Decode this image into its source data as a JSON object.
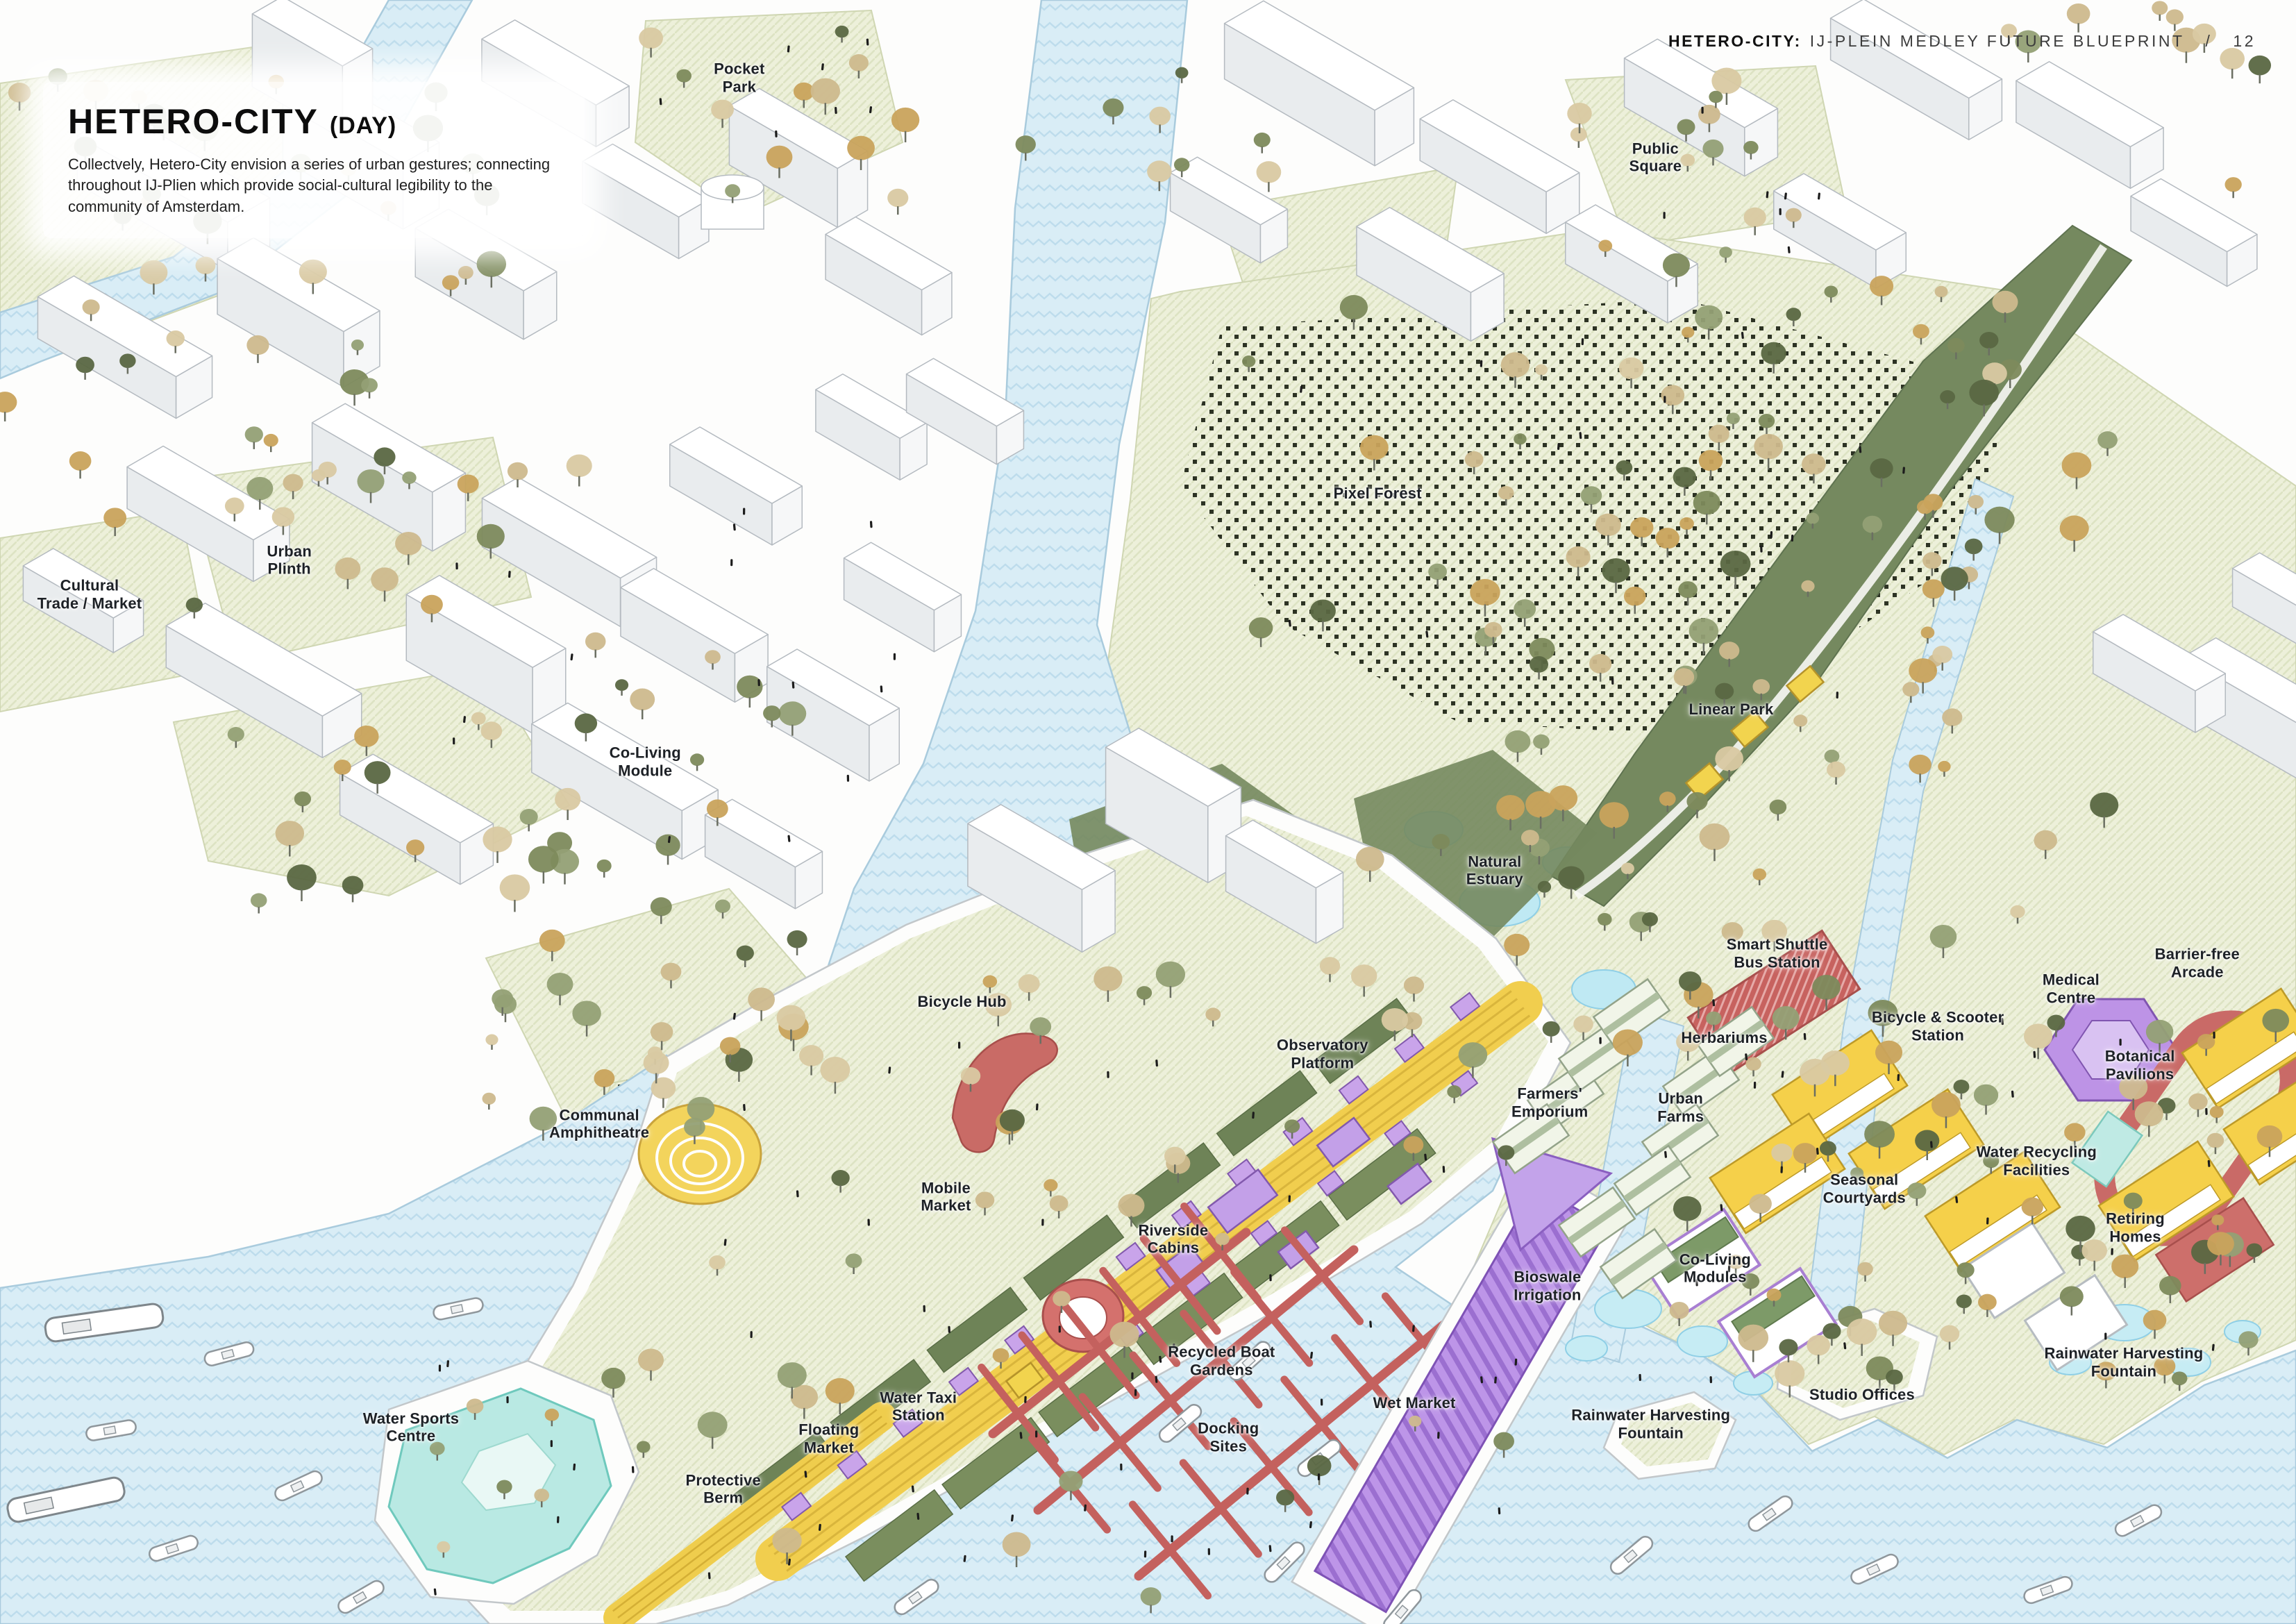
{
  "header": {
    "brand": "HETERO-CITY:",
    "title": "IJ-PLEIN MEDLEY FUTURE BLUEPRINT",
    "separator": "/",
    "page_number": "12"
  },
  "title_block": {
    "title": "HETERO-CITY",
    "subtitle": "(DAY)",
    "description": "Collectvely, Hetero-City envision a series of urban gestures; connecting throughout IJ-Plien which provide social-cultural legibility to the community of Amsterdam."
  },
  "map": {
    "labels": [
      {
        "id": "pocket-park",
        "text": "Pocket\nPark",
        "x": 32.2,
        "y": 4.8
      },
      {
        "id": "public-square",
        "text": "Public\nSquare",
        "x": 72.1,
        "y": 9.7
      },
      {
        "id": "pixel-forest",
        "text": "Pixel Forest",
        "x": 60.0,
        "y": 30.4
      },
      {
        "id": "urban-plinth",
        "text": "Urban\nPlinth",
        "x": 12.6,
        "y": 34.5
      },
      {
        "id": "cultural-trade-market",
        "text": "Cultural\nTrade / Market",
        "x": 3.9,
        "y": 36.6
      },
      {
        "id": "co-living-module",
        "text": "Co-Living\nModule",
        "x": 28.1,
        "y": 46.9
      },
      {
        "id": "linear-park",
        "text": "Linear Park",
        "x": 75.4,
        "y": 43.7
      },
      {
        "id": "natural-estuary",
        "text": "Natural\nEstuary",
        "x": 65.1,
        "y": 53.6
      },
      {
        "id": "smart-shuttle-bus-station",
        "text": "Smart Shuttle\nBus Station",
        "x": 77.4,
        "y": 58.7
      },
      {
        "id": "medical-centre",
        "text": "Medical\nCentre",
        "x": 90.2,
        "y": 60.9
      },
      {
        "id": "barrier-free-arcade",
        "text": "Barrier-free\nArcade",
        "x": 95.7,
        "y": 59.3
      },
      {
        "id": "bicycle-scooter-station",
        "text": "Bicycle & Scooter\nStation",
        "x": 84.4,
        "y": 63.2
      },
      {
        "id": "botanical-pavilions",
        "text": "Botanical\nPavilions",
        "x": 93.2,
        "y": 65.6
      },
      {
        "id": "bicycle-hub",
        "text": "Bicycle Hub",
        "x": 41.9,
        "y": 61.7
      },
      {
        "id": "observatory-platform",
        "text": "Observatory\nPlatform",
        "x": 57.6,
        "y": 64.9
      },
      {
        "id": "herbariums",
        "text": "Herbariums",
        "x": 75.1,
        "y": 63.9
      },
      {
        "id": "farmers-emporium",
        "text": "Farmers'\nEmporium",
        "x": 67.5,
        "y": 67.9
      },
      {
        "id": "urban-farms",
        "text": "Urban\nFarms",
        "x": 73.2,
        "y": 68.2
      },
      {
        "id": "communal-amphitheatre",
        "text": "Communal\nAmphitheatre",
        "x": 26.1,
        "y": 69.2
      },
      {
        "id": "mobile-market",
        "text": "Mobile\nMarket",
        "x": 41.2,
        "y": 73.7
      },
      {
        "id": "water-recycling-facilities",
        "text": "Water Recycling\nFacilities",
        "x": 88.7,
        "y": 71.5
      },
      {
        "id": "seasonal-courtyards",
        "text": "Seasonal\nCourtyards",
        "x": 81.2,
        "y": 73.2
      },
      {
        "id": "retiring-homes",
        "text": "Retiring\nHomes",
        "x": 93.0,
        "y": 75.6
      },
      {
        "id": "riverside-cabins",
        "text": "Riverside\nCabins",
        "x": 51.1,
        "y": 76.3
      },
      {
        "id": "co-living-modules",
        "text": "Co-Living\nModules",
        "x": 74.7,
        "y": 78.1
      },
      {
        "id": "bioswale-irrigation",
        "text": "Bioswale\nIrrigation",
        "x": 67.4,
        "y": 79.2
      },
      {
        "id": "rainwater-harvesting-fountain-east",
        "text": "Rainwater Harvesting\nFountain",
        "x": 92.5,
        "y": 83.9
      },
      {
        "id": "studio-offices",
        "text": "Studio Offices",
        "x": 81.1,
        "y": 85.9
      },
      {
        "id": "recycled-boat-gardens",
        "text": "Recycled Boat\nGardens",
        "x": 53.2,
        "y": 83.8
      },
      {
        "id": "water-taxi-station",
        "text": "Water Taxi\nStation",
        "x": 40.0,
        "y": 86.6
      },
      {
        "id": "wet-market",
        "text": "Wet Market",
        "x": 61.6,
        "y": 86.4
      },
      {
        "id": "floating-market",
        "text": "Floating\nMarket",
        "x": 36.1,
        "y": 88.6
      },
      {
        "id": "docking-sites",
        "text": "Docking\nSites",
        "x": 53.5,
        "y": 88.5
      },
      {
        "id": "rainwater-harvesting-fountain-south",
        "text": "Rainwater Harvesting\nFountain",
        "x": 71.9,
        "y": 87.7
      },
      {
        "id": "water-sports-centre",
        "text": "Water Sports\nCentre",
        "x": 17.9,
        "y": 87.9
      },
      {
        "id": "protective-berm",
        "text": "Protective\nBerm",
        "x": 31.5,
        "y": 91.7
      }
    ]
  },
  "palette": {
    "water": "#d9edf6",
    "water_wave": "#bddcec",
    "land": "#ffffff",
    "park_green": "#edf0da",
    "sage_green": "#75895f",
    "path_yellow": "#f1ce4e",
    "market_purple": "#c2a0e8",
    "coral_red": "#c96b66",
    "pool_cyan": "#b9e9e3",
    "tree_olive": "#7d8a5c",
    "label_ink": "#1d2126"
  }
}
